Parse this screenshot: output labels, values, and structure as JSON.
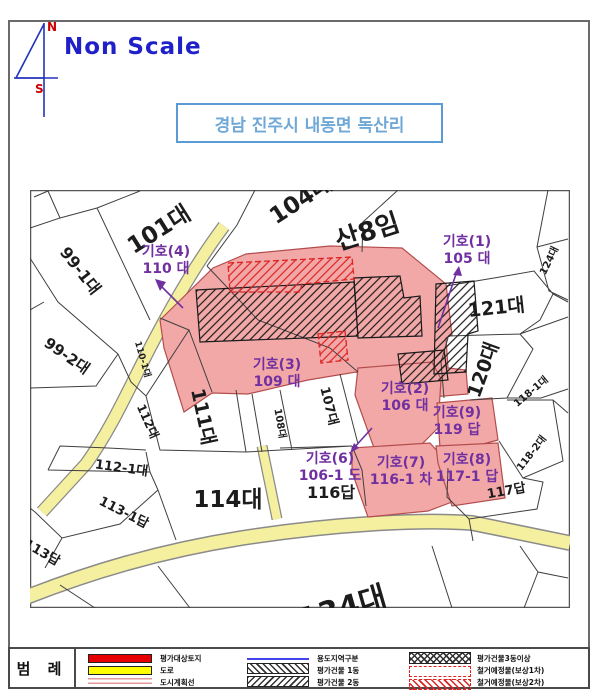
{
  "header": {
    "scale_note": "Non Scale",
    "compass_north": "N",
    "compass_south": "S",
    "location_title": "경남 진주시 내동면 독산리"
  },
  "colors": {
    "accent_blue": "#2020c8",
    "title_blue": "#6fa8d6",
    "marker_purple": "#7030a0",
    "highlight_pink": "#f3a8a8",
    "legend_red": "#e60000",
    "road_yellow": "#f5f0a0",
    "dashed_red": "#dd2222"
  },
  "map": {
    "labels": [
      {
        "t": "101대",
        "x": 163,
        "y": 236,
        "r": -32,
        "s": 23
      },
      {
        "t": "104대",
        "x": 305,
        "y": 206,
        "r": -33,
        "s": 23
      },
      {
        "t": "산8임",
        "x": 370,
        "y": 240,
        "r": -18,
        "s": 26
      },
      {
        "t": "124대",
        "x": 552,
        "y": 262,
        "r": -64,
        "s": 10
      },
      {
        "t": "121대",
        "x": 497,
        "y": 314,
        "r": -6,
        "s": 19
      },
      {
        "t": "120대",
        "x": 489,
        "y": 372,
        "r": -70,
        "s": 19
      },
      {
        "t": "118-1대",
        "x": 533,
        "y": 394,
        "r": -40,
        "s": 10
      },
      {
        "t": "118-2대",
        "x": 534,
        "y": 455,
        "r": -52,
        "s": 10
      },
      {
        "t": "117답",
        "x": 507,
        "y": 495,
        "r": -10,
        "s": 13
      },
      {
        "t": "99-1대",
        "x": 76,
        "y": 274,
        "r": 52,
        "s": 16
      },
      {
        "t": "99-2대",
        "x": 64,
        "y": 360,
        "r": 35,
        "s": 15
      },
      {
        "t": "110-1대",
        "x": 140,
        "y": 360,
        "r": 74,
        "s": 9
      },
      {
        "t": "112대",
        "x": 144,
        "y": 423,
        "r": 66,
        "s": 12
      },
      {
        "t": "111대",
        "x": 197,
        "y": 418,
        "r": 78,
        "s": 19
      },
      {
        "t": "108대",
        "x": 277,
        "y": 424,
        "r": 80,
        "s": 10
      },
      {
        "t": "107대",
        "x": 325,
        "y": 407,
        "r": 76,
        "s": 13
      },
      {
        "t": "112-1대",
        "x": 121,
        "y": 472,
        "r": 8,
        "s": 13
      },
      {
        "t": "113-1답",
        "x": 122,
        "y": 516,
        "r": 27,
        "s": 13
      },
      {
        "t": "113답",
        "x": 40,
        "y": 556,
        "r": 30,
        "s": 13
      },
      {
        "t": "114대",
        "x": 228,
        "y": 507,
        "r": 0,
        "s": 23
      },
      {
        "t": "116답",
        "x": 331,
        "y": 498,
        "r": 0,
        "s": 16
      },
      {
        "t": "134대",
        "x": 345,
        "y": 618,
        "r": -16,
        "s": 30
      }
    ],
    "markers": [
      {
        "l1": "기호(4)",
        "l2": "110 대",
        "x": 166,
        "y": 256
      },
      {
        "l1": "기호(1)",
        "l2": "105 대",
        "x": 467,
        "y": 246
      },
      {
        "l1": "기호(3)",
        "l2": "109 대",
        "x": 277,
        "y": 369
      },
      {
        "l1": "기호(2)",
        "l2": "106 대",
        "x": 405,
        "y": 393
      },
      {
        "l1": "기호(9)",
        "l2": "119 답",
        "x": 457,
        "y": 417
      },
      {
        "l1": "기호(6)",
        "l2": "106-1 도",
        "x": 330,
        "y": 463
      },
      {
        "l1": "기호(7)",
        "l2": "116-1 차",
        "x": 401,
        "y": 467
      },
      {
        "l1": "기호(8)",
        "l2": "117-1 답",
        "x": 467,
        "y": 464
      }
    ]
  },
  "legend": {
    "title": "범 례",
    "items": [
      {
        "key": "target-land",
        "label": "평가대상토지"
      },
      {
        "key": "road",
        "label": "도로"
      },
      {
        "key": "city-plan-line",
        "label": "도시계획선"
      },
      {
        "key": "use-district",
        "label": "용도지역구분"
      },
      {
        "key": "building-1",
        "label": "평가건물 1동"
      },
      {
        "key": "building-2",
        "label": "평가건물 2동"
      },
      {
        "key": "building-3plus",
        "label": "평가건물3동이상"
      },
      {
        "key": "demolition-1",
        "label": "철거예정물(보상1차)"
      },
      {
        "key": "demolition-2",
        "label": "철거예정물(보상2차)"
      }
    ]
  }
}
